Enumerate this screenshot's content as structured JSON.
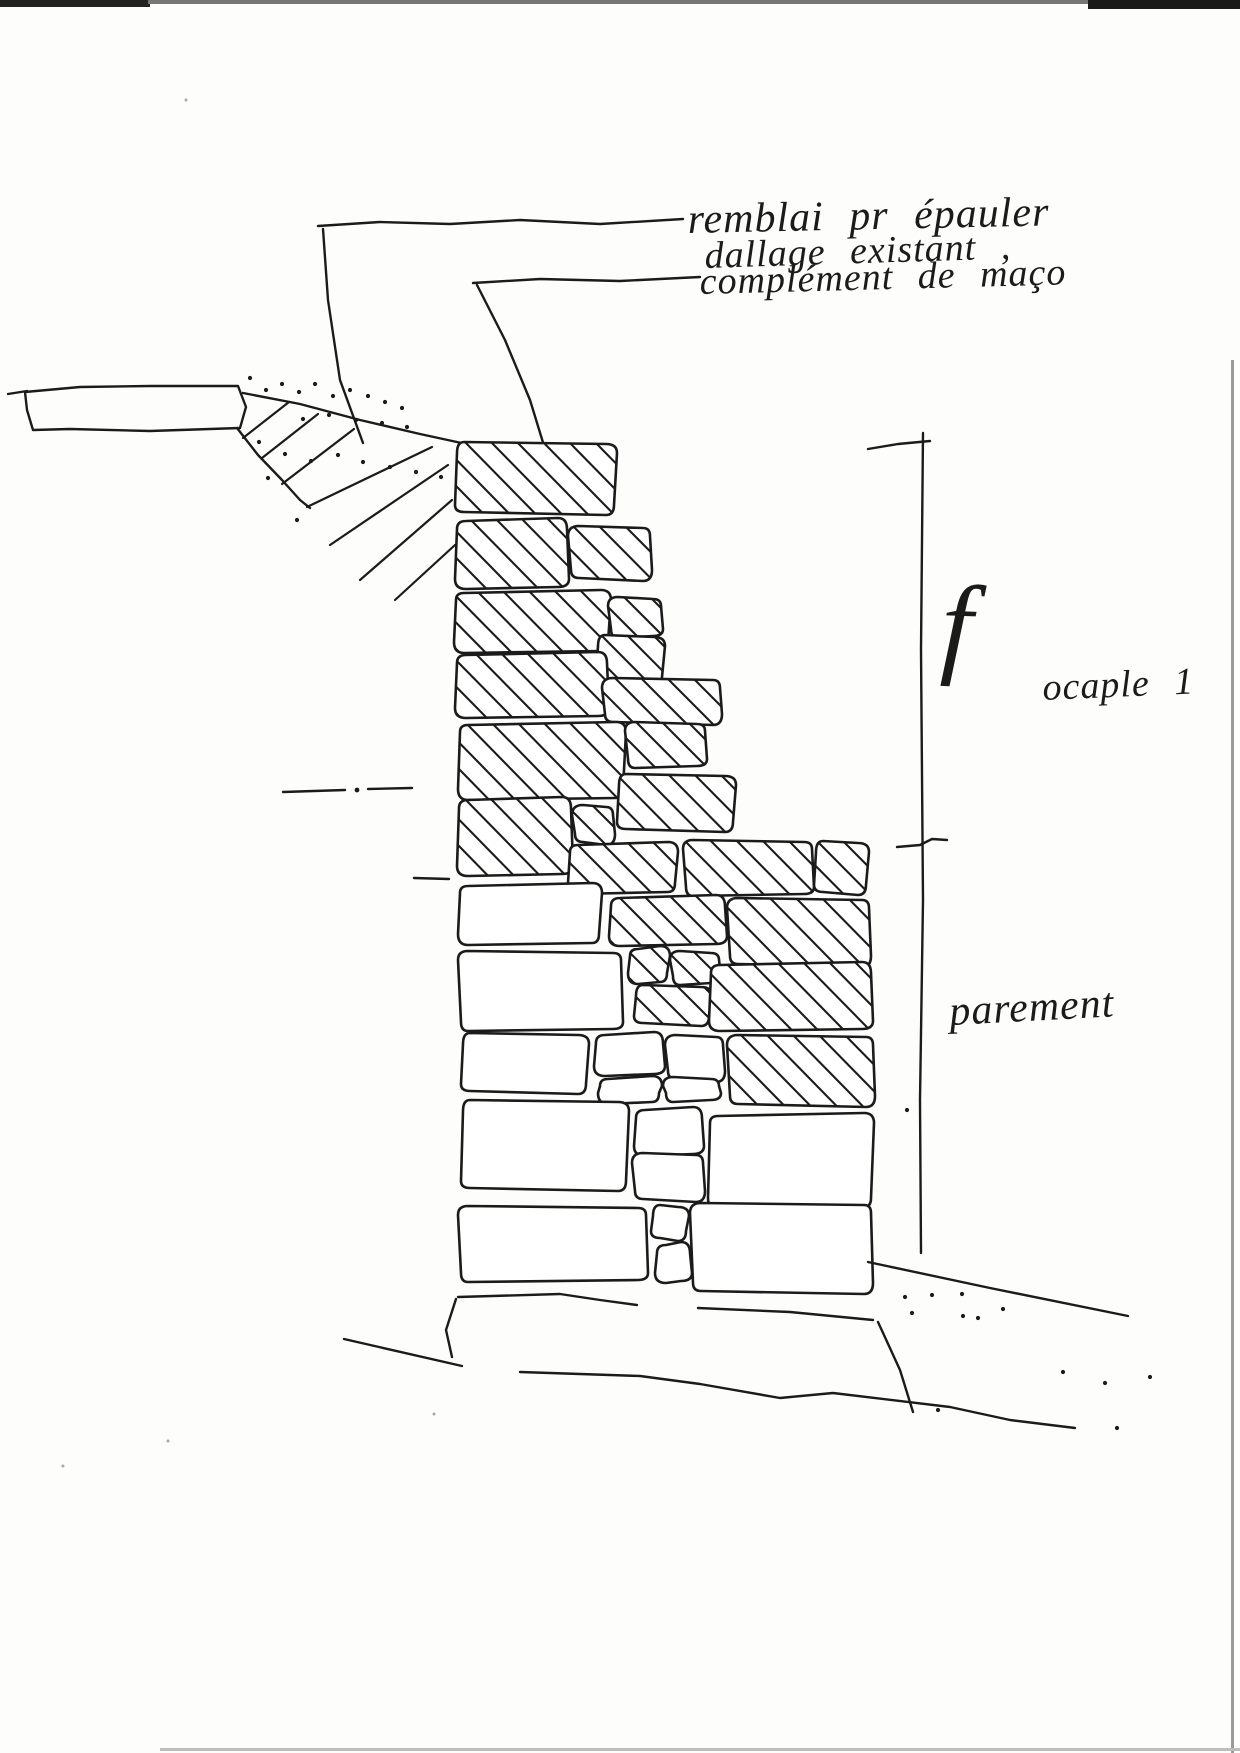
{
  "title": "hand sketch - stone wall cross-section with French annotations",
  "ink": "#1b1b1b",
  "paper": "#fdfdfc",
  "labels": {
    "remblai": "remblai  pr  épauler",
    "dallage": "dallage  existant  ,",
    "complement": "complément  de  maço",
    "f_mark": "f",
    "ocaple": "ocaple  1",
    "parement": "parement"
  },
  "sketch": {
    "blocks": [
      {
        "x": 455,
        "y": 444,
        "w": 160,
        "h": 70,
        "hatch": true
      },
      {
        "x": 457,
        "y": 520,
        "w": 110,
        "h": 68,
        "hatch": true
      },
      {
        "x": 570,
        "y": 527,
        "w": 82,
        "h": 52,
        "hatch": true
      },
      {
        "x": 455,
        "y": 591,
        "w": 155,
        "h": 60,
        "hatch": true
      },
      {
        "x": 609,
        "y": 597,
        "w": 53,
        "h": 41,
        "hatch": true
      },
      {
        "x": 596,
        "y": 637,
        "w": 67,
        "h": 49,
        "hatch": true
      },
      {
        "x": 457,
        "y": 654,
        "w": 150,
        "h": 63,
        "hatch": true
      },
      {
        "x": 604,
        "y": 679,
        "w": 118,
        "h": 44,
        "hatch": true
      },
      {
        "x": 459,
        "y": 723,
        "w": 166,
        "h": 75,
        "hatch": true
      },
      {
        "x": 626,
        "y": 722,
        "w": 80,
        "h": 46,
        "hatch": true
      },
      {
        "x": 617,
        "y": 776,
        "w": 117,
        "h": 55,
        "hatch": true
      },
      {
        "x": 459,
        "y": 799,
        "w": 112,
        "h": 76,
        "hatch": true
      },
      {
        "x": 574,
        "y": 806,
        "w": 41,
        "h": 37,
        "hatch": true
      },
      {
        "x": 569,
        "y": 843,
        "w": 108,
        "h": 49,
        "hatch": true
      },
      {
        "x": 684,
        "y": 840,
        "w": 129,
        "h": 56,
        "hatch": true
      },
      {
        "x": 814,
        "y": 843,
        "w": 53,
        "h": 51,
        "hatch": true
      },
      {
        "x": 611,
        "y": 897,
        "w": 114,
        "h": 48,
        "hatch": true
      },
      {
        "x": 729,
        "y": 899,
        "w": 142,
        "h": 66,
        "hatch": true
      },
      {
        "x": 629,
        "y": 947,
        "w": 40,
        "h": 35,
        "hatch": true
      },
      {
        "x": 671,
        "y": 951,
        "w": 49,
        "h": 34,
        "hatch": true
      },
      {
        "x": 634,
        "y": 987,
        "w": 76,
        "h": 38,
        "hatch": true
      },
      {
        "x": 711,
        "y": 964,
        "w": 160,
        "h": 66,
        "hatch": true
      },
      {
        "x": 729,
        "y": 1036,
        "w": 146,
        "h": 69,
        "hatch": true
      },
      {
        "x": 459,
        "y": 884,
        "w": 142,
        "h": 59,
        "hatch": false
      },
      {
        "x": 459,
        "y": 951,
        "w": 163,
        "h": 80,
        "hatch": false
      },
      {
        "x": 461,
        "y": 1035,
        "w": 126,
        "h": 58,
        "hatch": false
      },
      {
        "x": 596,
        "y": 1034,
        "w": 67,
        "h": 41,
        "hatch": false
      },
      {
        "x": 667,
        "y": 1036,
        "w": 58,
        "h": 44,
        "hatch": false
      },
      {
        "x": 599,
        "y": 1077,
        "w": 62,
        "h": 25,
        "hatch": false
      },
      {
        "x": 664,
        "y": 1077,
        "w": 56,
        "h": 25,
        "hatch": false
      },
      {
        "x": 461,
        "y": 1102,
        "w": 166,
        "h": 88,
        "hatch": false
      },
      {
        "x": 636,
        "y": 1109,
        "w": 66,
        "h": 46,
        "hatch": false
      },
      {
        "x": 634,
        "y": 1154,
        "w": 71,
        "h": 46,
        "hatch": false
      },
      {
        "x": 709,
        "y": 1114,
        "w": 164,
        "h": 93,
        "hatch": false
      },
      {
        "x": 459,
        "y": 1206,
        "w": 188,
        "h": 76,
        "hatch": false
      },
      {
        "x": 651,
        "y": 1207,
        "w": 36,
        "h": 33,
        "hatch": false
      },
      {
        "x": 657,
        "y": 1244,
        "w": 33,
        "h": 38,
        "hatch": false
      },
      {
        "x": 692,
        "y": 1204,
        "w": 181,
        "h": 88,
        "hatch": false
      }
    ],
    "slab": {
      "outline": [
        [
          25,
          392
        ],
        [
          80,
          387
        ],
        [
          150,
          386
        ],
        [
          238,
          386
        ],
        [
          246,
          407
        ],
        [
          240,
          428
        ],
        [
          150,
          431
        ],
        [
          70,
          429
        ],
        [
          33,
          430
        ],
        [
          27,
          410
        ]
      ],
      "tail": [
        [
          8,
          394
        ],
        [
          27,
          391
        ]
      ]
    },
    "wedge": {
      "top_edge": [
        [
          243,
          393
        ],
        [
          300,
          404
        ],
        [
          360,
          420
        ],
        [
          420,
          434
        ],
        [
          480,
          447
        ]
      ],
      "boundary": [
        [
          237,
          428
        ],
        [
          258,
          455
        ],
        [
          282,
          480
        ],
        [
          300,
          500
        ],
        [
          310,
          508
        ]
      ],
      "strokes": [
        [
          [
            243,
            438
          ],
          [
            289,
            402
          ]
        ],
        [
          [
            262,
            458
          ],
          [
            318,
            414
          ]
        ],
        [
          [
            282,
            484
          ],
          [
            354,
            429
          ]
        ],
        [
          [
            307,
            507
          ],
          [
            432,
            447
          ]
        ],
        [
          [
            330,
            545
          ],
          [
            448,
            465
          ]
        ],
        [
          [
            360,
            580
          ],
          [
            452,
            500
          ]
        ],
        [
          [
            395,
            600
          ],
          [
            455,
            545
          ]
        ]
      ]
    },
    "leaders": [
      [
        [
          318,
          226
        ],
        [
          380,
          222
        ],
        [
          450,
          224
        ],
        [
          520,
          220
        ],
        [
          600,
          224
        ],
        [
          683,
          219
        ]
      ],
      [
        [
          323,
          229
        ],
        [
          328,
          300
        ],
        [
          340,
          380
        ],
        [
          363,
          443
        ]
      ],
      [
        [
          473,
          283
        ],
        [
          540,
          279
        ],
        [
          620,
          281
        ],
        [
          700,
          277
        ]
      ],
      [
        [
          477,
          285
        ],
        [
          505,
          340
        ],
        [
          530,
          400
        ],
        [
          545,
          449
        ]
      ]
    ],
    "dimension": {
      "main": [
        [
          923,
          433
        ],
        [
          921,
          650
        ],
        [
          923,
          900
        ],
        [
          920,
          1100
        ],
        [
          921,
          1253
        ]
      ],
      "top_tick": [
        [
          868,
          449
        ],
        [
          898,
          444
        ],
        [
          930,
          441
        ]
      ],
      "mid_tick": [
        [
          897,
          847
        ],
        [
          920,
          845
        ],
        [
          932,
          839
        ],
        [
          947,
          840
        ]
      ]
    },
    "dashdot": {
      "dashes": [
        [
          [
            283,
            792
          ],
          [
            345,
            790
          ]
        ],
        [
          [
            368,
            789
          ],
          [
            412,
            788
          ]
        ],
        [
          [
            414,
            878
          ],
          [
            449,
            879
          ]
        ]
      ],
      "dots": [
        [
          357,
          790
        ]
      ]
    },
    "ground": [
      [
        [
          458,
          1297
        ],
        [
          560,
          1294
        ],
        [
          600,
          1300
        ],
        [
          637,
          1305
        ]
      ],
      [
        [
          698,
          1308
        ],
        [
          790,
          1312
        ],
        [
          873,
          1320
        ]
      ],
      [
        [
          868,
          1262
        ],
        [
          990,
          1288
        ],
        [
          1128,
          1316
        ]
      ],
      [
        [
          456,
          1299
        ],
        [
          446,
          1330
        ],
        [
          452,
          1357
        ]
      ],
      [
        [
          344,
          1339
        ],
        [
          462,
          1366
        ]
      ],
      [
        [
          520,
          1372
        ],
        [
          640,
          1376
        ],
        [
          700,
          1384
        ],
        [
          780,
          1398
        ],
        [
          833,
          1393
        ],
        [
          950,
          1407
        ],
        [
          1010,
          1420
        ],
        [
          1075,
          1428
        ]
      ],
      [
        [
          878,
          1322
        ],
        [
          900,
          1370
        ],
        [
          913,
          1412
        ]
      ]
    ],
    "dots_slope": [
      [
        250,
        378
      ],
      [
        266,
        390
      ],
      [
        282,
        384
      ],
      [
        299,
        392
      ],
      [
        315,
        384
      ],
      [
        333,
        396
      ],
      [
        350,
        390
      ],
      [
        368,
        396
      ],
      [
        385,
        402
      ],
      [
        402,
        408
      ],
      [
        303,
        419
      ],
      [
        329,
        415
      ],
      [
        356,
        420
      ],
      [
        382,
        423
      ],
      [
        407,
        427
      ],
      [
        259,
        442
      ],
      [
        285,
        454
      ],
      [
        311,
        461
      ],
      [
        338,
        455
      ],
      [
        363,
        462
      ],
      [
        390,
        467
      ],
      [
        416,
        472
      ],
      [
        441,
        477
      ],
      [
        268,
        478
      ],
      [
        297,
        520
      ]
    ],
    "dots_ground": [
      [
        905,
        1297
      ],
      [
        932,
        1295
      ],
      [
        962,
        1294
      ],
      [
        912,
        1313
      ],
      [
        963,
        1316
      ],
      [
        978,
        1318
      ],
      [
        1003,
        1309
      ],
      [
        938,
        1410
      ],
      [
        1063,
        1372
      ],
      [
        1105,
        1383
      ],
      [
        1150,
        1377
      ],
      [
        1117,
        1428
      ],
      [
        907,
        1110
      ]
    ],
    "specks": [
      [
        186,
        100
      ],
      [
        63,
        1466
      ],
      [
        434,
        1414
      ],
      [
        168,
        1441
      ]
    ]
  },
  "scan": {
    "bars": [
      {
        "x": 0,
        "y": 0,
        "w": 150,
        "h": 7,
        "c": "#222222"
      },
      {
        "x": 148,
        "y": 0,
        "w": 945,
        "h": 4,
        "c": "#777777"
      },
      {
        "x": 1088,
        "y": 0,
        "w": 152,
        "h": 9,
        "c": "#1a1a1a"
      },
      {
        "x": 1231,
        "y": 360,
        "w": 3,
        "h": 1393,
        "c": "#9a9a9a"
      },
      {
        "x": 160,
        "y": 1748,
        "w": 1080,
        "h": 3,
        "c": "#bdbdbd"
      }
    ]
  }
}
